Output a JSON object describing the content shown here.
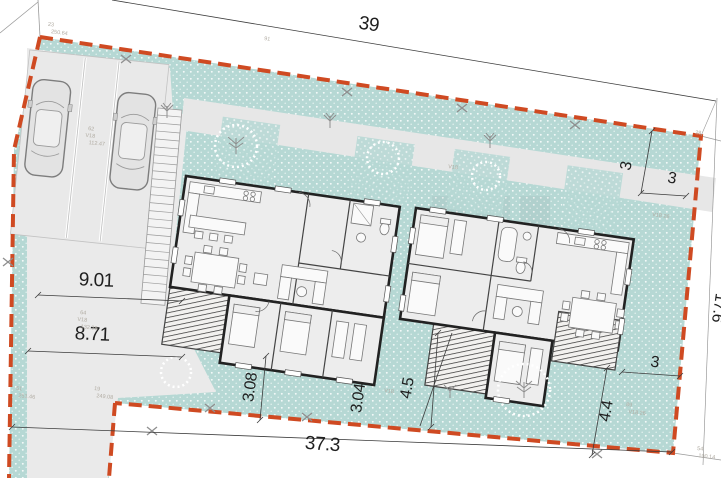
{
  "drawing": {
    "kind": "residential site plan with two duplex houses, parking and landscaped parcel",
    "boundary_color": "#cf4a22",
    "landscape_color": "#b6d8d4",
    "paving_color": "#eaeaea",
    "wall_color": "#222222"
  },
  "dimensions": {
    "top_width": "39",
    "right_side": "17.6",
    "bottom_width": "37.3",
    "parking_depth_upper": "9.01",
    "parking_depth_lower": "8.71",
    "setback_left_terrace": "3.08",
    "gap_between_houses": "3.04",
    "setback_right_gap": "4.5",
    "setback_ne_top": "3",
    "setback_ne_side": "3",
    "setback_se_side": "3",
    "terrace_depth_right": "4.4"
  },
  "survey_points": {
    "p23": {
      "id": "23",
      "elev": "250.64"
    },
    "p91": {
      "id": "91"
    },
    "p28": {
      "id": "28"
    },
    "p62": {
      "id": "62",
      "ref": "V18",
      "elev": "112.47"
    },
    "p64": {
      "id": "64",
      "ref": "V18",
      "elev": "132.38"
    },
    "p19": {
      "id": "19",
      "elev": "249.08"
    },
    "p51": {
      "id": "51",
      "elev": "251.46"
    },
    "p54": {
      "id": "54",
      "elev": "190.14"
    },
    "p89": {
      "id": "89",
      "ref": "V18 26"
    }
  }
}
